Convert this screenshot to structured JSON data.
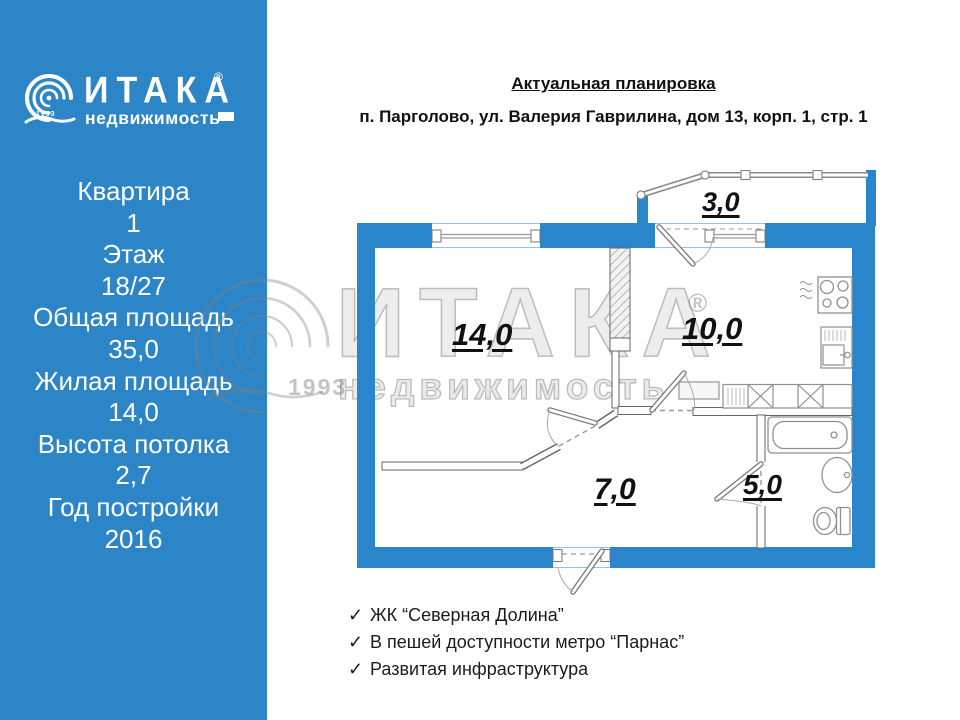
{
  "sidebar": {
    "logo": {
      "brand": "ИТАКА",
      "reg": "®",
      "sub": "недвижимость",
      "year": "1993"
    },
    "stats": [
      "Квартира",
      "1",
      "Этаж",
      "18/27",
      "Общая площадь",
      "35,0",
      "Жилая площадь",
      "14,0",
      "Высота потолка",
      "2,7",
      "Год постройки",
      "2016"
    ]
  },
  "header": {
    "title": "Актуальная планировка",
    "address": "п. Парголово, ул. Валерия Гаврилина, дом 13, корп. 1, стр. 1"
  },
  "plan": {
    "areas": {
      "room": "14,0",
      "kitchen": "10,0",
      "hallway": "7,0",
      "bathroom": "5,0",
      "balcony": "3,0"
    }
  },
  "watermark": {
    "brand": "ИТАКА",
    "reg": "®",
    "sub": "недвижимость",
    "year": "1993"
  },
  "features": {
    "check": "✓",
    "items": [
      "ЖК “Северная Долина”",
      "В пешей доступности метро “Парнас”",
      "Развитая инфраструктура"
    ]
  },
  "colors": {
    "brand_blue": "#2b85c6",
    "wall_blue": "#2a86ca",
    "fixture_gray": "#909090"
  }
}
